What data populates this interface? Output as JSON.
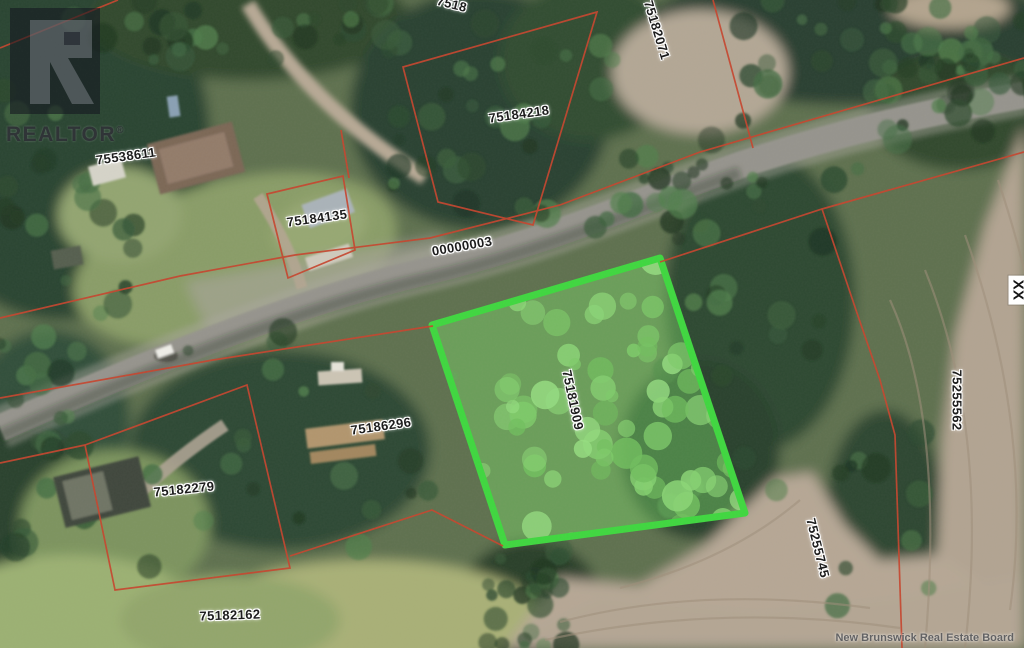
{
  "branding": {
    "logo_word": "REALTOR",
    "registered_mark": "®"
  },
  "watermark": "New Brunswick Real Estate Board",
  "map": {
    "type": "aerial-parcel-map",
    "road_label": "00000003",
    "highlighted_parcel": "75181909",
    "colors": {
      "highlight_green": "#3fd73f",
      "highlight_fill": "rgba(123,219,105,0.42)",
      "boundary_red": "#c6452e"
    },
    "parcel_labels": [
      {
        "text": "75538611",
        "x": 126,
        "y": 156,
        "rot": -8
      },
      {
        "text": "75184135",
        "x": 317,
        "y": 218,
        "rot": -8
      },
      {
        "text": "75184218",
        "x": 519,
        "y": 114,
        "rot": -8
      },
      {
        "text": "75182071",
        "x": 657,
        "y": 30,
        "rot": 73
      },
      {
        "text": "7518",
        "x": 452,
        "y": 4,
        "rot": 14,
        "variant": "clip-top"
      },
      {
        "text": "00000003",
        "x": 462,
        "y": 246,
        "rot": -10
      },
      {
        "text": "75181909",
        "x": 573,
        "y": 400,
        "rot": 78
      },
      {
        "text": "75186296",
        "x": 381,
        "y": 426,
        "rot": -8
      },
      {
        "text": "75182279",
        "x": 184,
        "y": 489,
        "rot": -6
      },
      {
        "text": "75182162",
        "x": 230,
        "y": 615,
        "rot": -2
      },
      {
        "text": "75255562",
        "x": 957,
        "y": 400,
        "rot": 90
      },
      {
        "text": "75255745",
        "x": 818,
        "y": 548,
        "rot": 76
      },
      {
        "text": "XX",
        "x": 1018,
        "y": 290,
        "rot": 90,
        "variant": "boxed"
      }
    ]
  }
}
